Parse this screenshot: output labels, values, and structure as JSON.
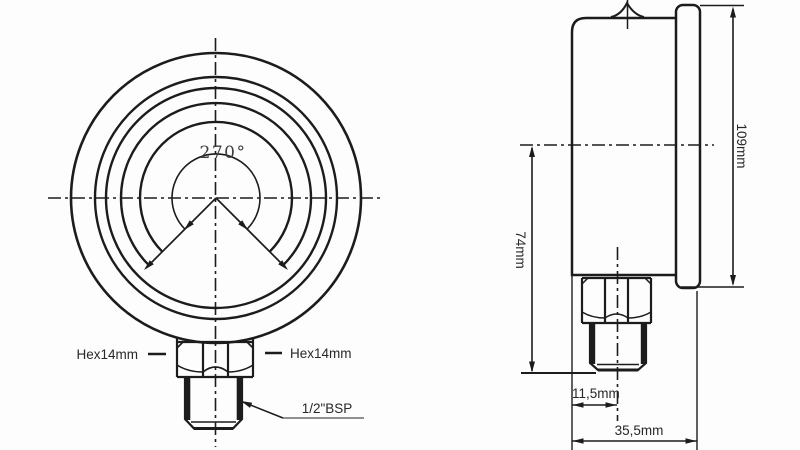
{
  "drawing": {
    "type": "pressure-gauge-dimension-drawing",
    "colors": {
      "background": "#fdfdfd",
      "line": "#1c1c1c",
      "leader_gray": "#8f8f8f",
      "label_text": "#282828",
      "angle_text": "#3e3e3e"
    },
    "front_view": {
      "angle_label": "270°",
      "hex_left_label": "Hex14mm",
      "hex_right_label": "Hex14mm",
      "thread_label": "1/2\"BSP"
    },
    "side_view": {
      "center_height_label": "74mm",
      "total_height_label": "109mm",
      "stem_offset_label": "11,5mm",
      "case_depth_label": "35,5mm"
    }
  }
}
